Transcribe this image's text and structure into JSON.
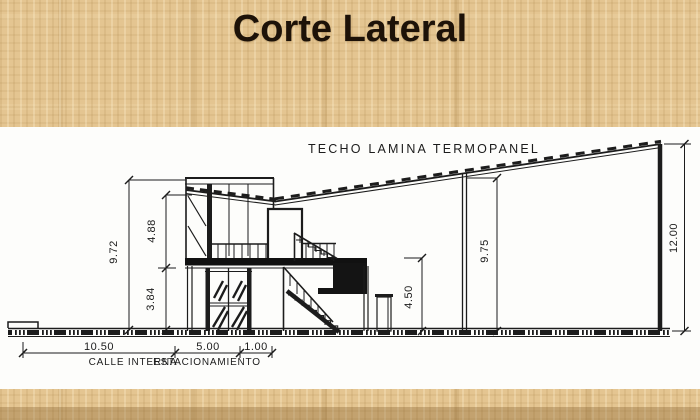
{
  "slide": {
    "title": "Corte Lateral",
    "background_color": "#e4c591",
    "panel_color": "#fdfdfb",
    "ink_color": "#1c1c1c"
  },
  "drawing": {
    "roof_label": "TECHO LAMINA TERMOPANEL",
    "dimensions": {
      "left_total_height": "9.72",
      "upper_level_height": "4.88",
      "lower_level_height": "3.84",
      "canopy_height": "4.50",
      "mid_column_height": "9.75",
      "right_wall_height": "12.00",
      "street_width": "10.50",
      "parking_width": "5.00",
      "walk_width": "1.00"
    },
    "zone_labels": {
      "street": "CALLE INTERNA",
      "parking": "ESTACIONAMIENTO"
    }
  }
}
